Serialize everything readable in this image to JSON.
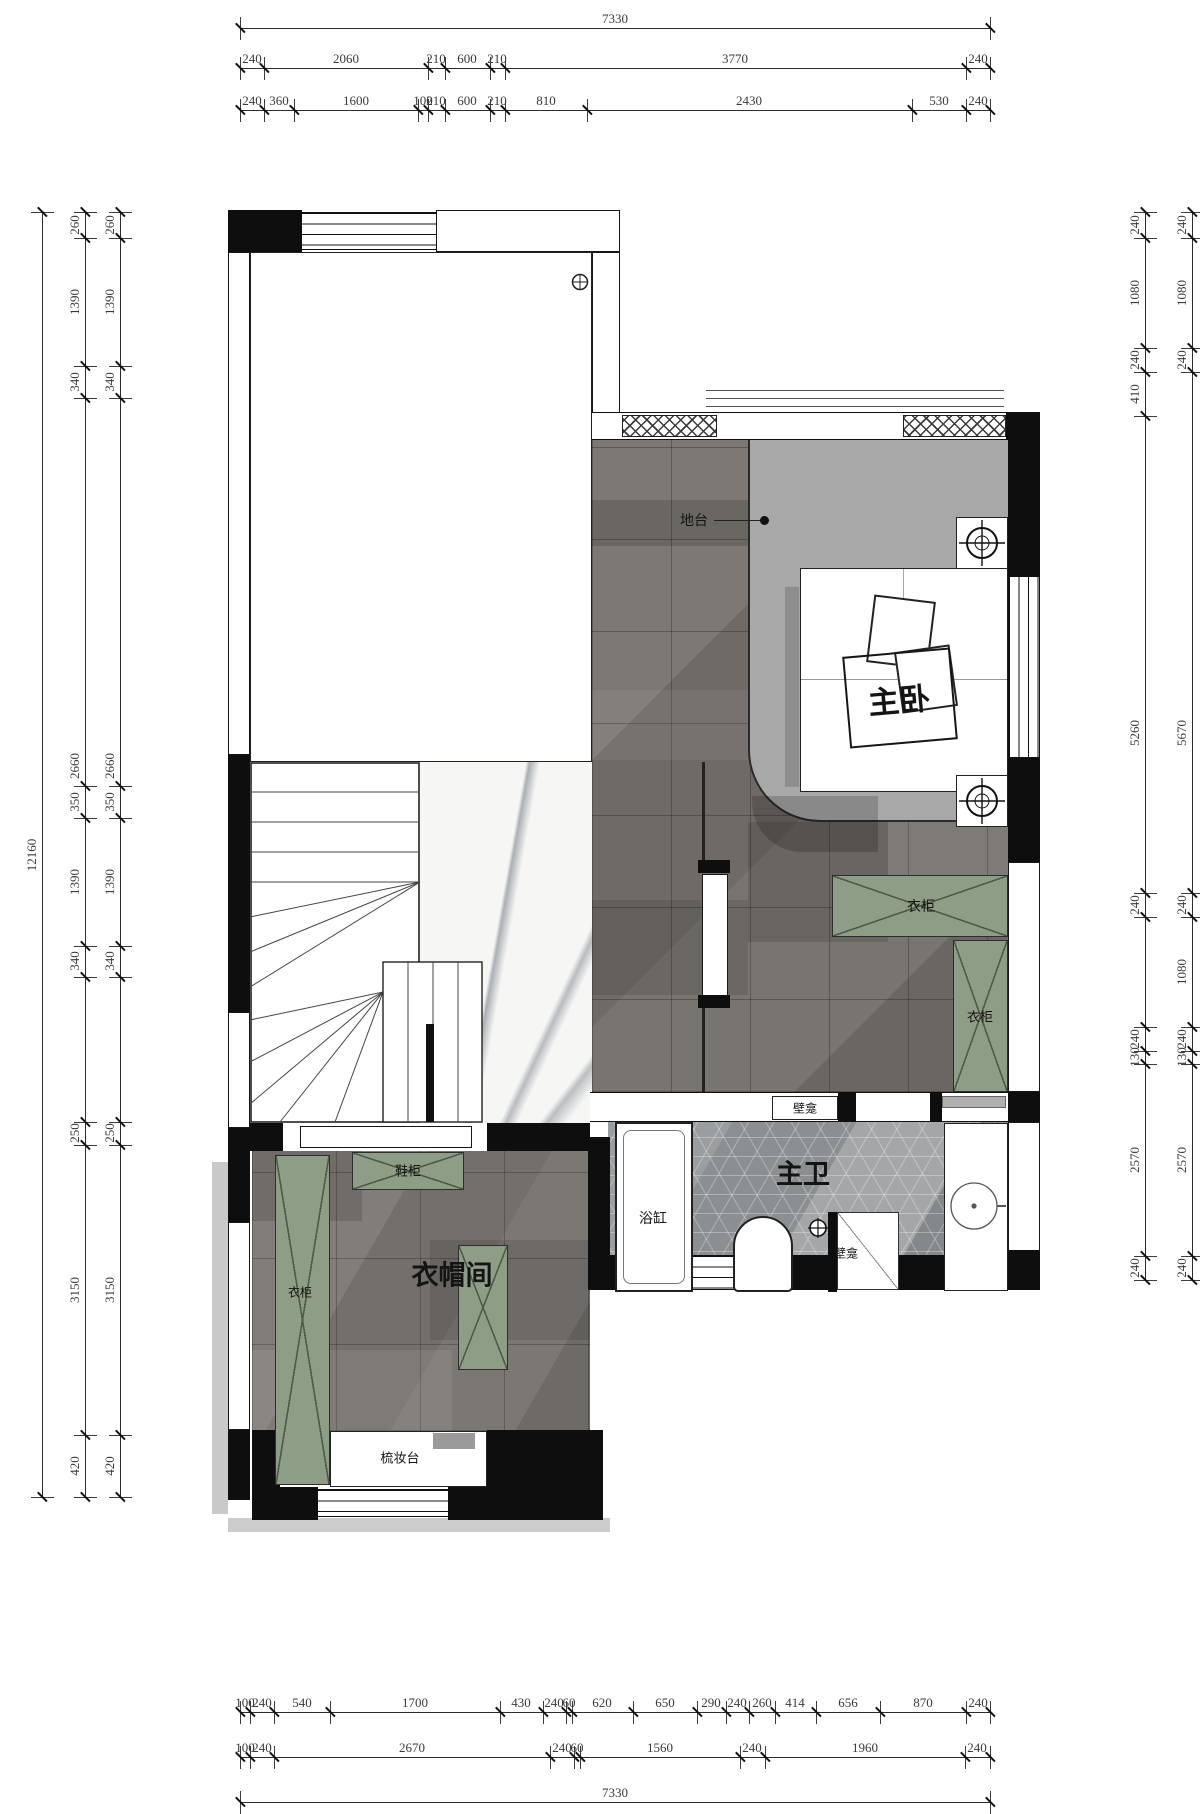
{
  "drawing": {
    "overall_width_label": "7330",
    "overall_height_label": "12160"
  },
  "plan_labels": [
    {
      "name": "label-platform",
      "text": "地台",
      "x": 694,
      "y": 520,
      "size": 14,
      "bold": false,
      "rot": 0
    },
    {
      "name": "label-master-bedroom",
      "text": "主卧",
      "x": 899,
      "y": 698,
      "size": 31,
      "bold": true,
      "rot": -5
    },
    {
      "name": "label-wardrobe-1",
      "text": "衣柜",
      "x": 921,
      "y": 906,
      "size": 14,
      "bold": false,
      "rot": 0
    },
    {
      "name": "label-wardrobe-2",
      "text": "衣柜",
      "x": 980,
      "y": 1016,
      "size": 13,
      "bold": false,
      "rot": 0
    },
    {
      "name": "label-wardrobe-3",
      "text": "衣柜",
      "x": 300,
      "y": 1292,
      "size": 12,
      "bold": false,
      "rot": 0
    },
    {
      "name": "label-shoe-cabinet",
      "text": "鞋柜",
      "x": 408,
      "y": 1170,
      "size": 13,
      "bold": false,
      "rot": 0
    },
    {
      "name": "label-walkin-closet",
      "text": "衣帽间",
      "x": 452,
      "y": 1273,
      "size": 27,
      "bold": true,
      "rot": 0
    },
    {
      "name": "label-dressing-table",
      "text": "梳妆台",
      "x": 400,
      "y": 1457,
      "size": 13,
      "bold": false,
      "rot": 0
    },
    {
      "name": "label-master-bath",
      "text": "主卫",
      "x": 803,
      "y": 1172,
      "size": 27,
      "bold": true,
      "rot": 0
    },
    {
      "name": "label-bathtub",
      "text": "浴缸",
      "x": 653,
      "y": 1218,
      "size": 14,
      "bold": false,
      "rot": 0
    },
    {
      "name": "label-niche-1",
      "text": "壁龛",
      "x": 805,
      "y": 1108,
      "size": 12,
      "bold": false,
      "rot": 0
    },
    {
      "name": "label-niche-2",
      "text": "壁龛",
      "x": 846,
      "y": 1253,
      "size": 12,
      "bold": false,
      "rot": 0
    }
  ],
  "dimensions": {
    "chains": [
      {
        "name": "dim-top-overall",
        "axis": "h",
        "line": 28,
        "from": 240,
        "to": 990,
        "ticks": [
          240,
          990
        ],
        "labels": [
          {
            "t": "7330",
            "at": 615
          }
        ]
      },
      {
        "name": "dim-top-mid",
        "axis": "h",
        "line": 68,
        "from": 240,
        "to": 990,
        "ticks": [
          240,
          264,
          428,
          445,
          490,
          505,
          966,
          990
        ],
        "labels": [
          {
            "t": "240",
            "at": 252
          },
          {
            "t": "2060",
            "at": 346
          },
          {
            "t": "210",
            "at": 436
          },
          {
            "t": "600",
            "at": 467
          },
          {
            "t": "210",
            "at": 497
          },
          {
            "t": "3770",
            "at": 735
          },
          {
            "t": "240",
            "at": 978
          }
        ]
      },
      {
        "name": "dim-top-fine",
        "axis": "h",
        "line": 110,
        "from": 240,
        "to": 990,
        "ticks": [
          240,
          264,
          294,
          418,
          428,
          445,
          490,
          505,
          587,
          912,
          966,
          990
        ],
        "labels": [
          {
            "t": "240",
            "at": 252
          },
          {
            "t": "360",
            "at": 279
          },
          {
            "t": "1600",
            "at": 356
          },
          {
            "t": "100",
            "at": 423
          },
          {
            "t": "210",
            "at": 436
          },
          {
            "t": "600",
            "at": 467
          },
          {
            "t": "210",
            "at": 497
          },
          {
            "t": "810",
            "at": 546
          },
          {
            "t": "2430",
            "at": 749
          },
          {
            "t": "530",
            "at": 939
          },
          {
            "t": "240",
            "at": 978
          }
        ]
      },
      {
        "name": "dim-bottom-fine",
        "axis": "h",
        "line": 1712,
        "from": 240,
        "to": 990,
        "text_dy": -17,
        "ticks": [
          240,
          250,
          274,
          330,
          500,
          543,
          566,
          572,
          633,
          697,
          726,
          749,
          775,
          816,
          880,
          966,
          990
        ],
        "labels": [
          {
            "t": "100",
            "at": 245
          },
          {
            "t": "240",
            "at": 262
          },
          {
            "t": "540",
            "at": 302
          },
          {
            "t": "1700",
            "at": 415
          },
          {
            "t": "430",
            "at": 521
          },
          {
            "t": "240",
            "at": 554
          },
          {
            "t": "60",
            "at": 569
          },
          {
            "t": "620",
            "at": 602
          },
          {
            "t": "650",
            "at": 665
          },
          {
            "t": "290",
            "at": 711
          },
          {
            "t": "240",
            "at": 737
          },
          {
            "t": "260",
            "at": 762
          },
          {
            "t": "414",
            "at": 795
          },
          {
            "t": "656",
            "at": 848
          },
          {
            "t": "870",
            "at": 923
          },
          {
            "t": "240",
            "at": 978
          }
        ]
      },
      {
        "name": "dim-bottom-mid",
        "axis": "h",
        "line": 1757,
        "from": 240,
        "to": 990,
        "ticks": [
          240,
          250,
          274,
          550,
          574,
          580,
          740,
          765,
          965,
          990
        ],
        "labels": [
          {
            "t": "100",
            "at": 245
          },
          {
            "t": "240",
            "at": 262
          },
          {
            "t": "2670",
            "at": 412
          },
          {
            "t": "240",
            "at": 562
          },
          {
            "t": "60",
            "at": 577
          },
          {
            "t": "1560",
            "at": 660
          },
          {
            "t": "240",
            "at": 752
          },
          {
            "t": "1960",
            "at": 865
          },
          {
            "t": "240",
            "at": 977
          }
        ]
      },
      {
        "name": "dim-bottom-overall",
        "axis": "h",
        "line": 1802,
        "from": 240,
        "to": 990,
        "ticks": [
          240,
          990
        ],
        "labels": [
          {
            "t": "7330",
            "at": 615
          }
        ]
      },
      {
        "name": "dim-left-overall",
        "axis": "v",
        "line": 42,
        "from": 212,
        "to": 1497,
        "ticks": [
          212,
          1497
        ],
        "labels": [
          {
            "t": "12160",
            "at": 855
          }
        ]
      },
      {
        "name": "dim-left-mid",
        "axis": "v",
        "line": 85,
        "from": 212,
        "to": 1497,
        "ticks": [
          212,
          238,
          366,
          398,
          786,
          818,
          946,
          977,
          1122,
          1145,
          1435,
          1497
        ],
        "labels": [
          {
            "t": "260",
            "at": 225
          },
          {
            "t": "1390",
            "at": 302
          },
          {
            "t": "340",
            "at": 382
          },
          {
            "t": "2660",
            "at": 766
          },
          {
            "t": "350",
            "at": 802
          },
          {
            "t": "1390",
            "at": 882
          },
          {
            "t": "340",
            "at": 961
          },
          {
            "t": "250",
            "at": 1133
          },
          {
            "t": "3150",
            "at": 1290
          },
          {
            "t": "420",
            "at": 1466
          }
        ]
      },
      {
        "name": "dim-left-fine",
        "axis": "v",
        "line": 120,
        "from": 212,
        "to": 1497,
        "ticks": [
          212,
          238,
          366,
          398,
          786,
          818,
          946,
          977,
          1122,
          1145,
          1435,
          1497
        ],
        "labels": [
          {
            "t": "260",
            "at": 225
          },
          {
            "t": "1390",
            "at": 302
          },
          {
            "t": "340",
            "at": 382
          },
          {
            "t": "2660",
            "at": 766
          },
          {
            "t": "350",
            "at": 802
          },
          {
            "t": "1390",
            "at": 882
          },
          {
            "t": "340",
            "at": 961
          },
          {
            "t": "250",
            "at": 1133
          },
          {
            "t": "3150",
            "at": 1290
          },
          {
            "t": "420",
            "at": 1466
          }
        ]
      },
      {
        "name": "dim-right-inner",
        "axis": "v",
        "line": 1145,
        "from": 212,
        "to": 1280,
        "ticks": [
          212,
          238,
          348,
          372,
          416,
          893,
          917,
          1027,
          1051,
          1064,
          1256,
          1280
        ],
        "labels": [
          {
            "t": "240",
            "at": 225
          },
          {
            "t": "1080",
            "at": 293
          },
          {
            "t": "240",
            "at": 360
          },
          {
            "t": "410",
            "at": 394
          },
          {
            "t": "5260",
            "at": 733
          },
          {
            "t": "240",
            "at": 905
          },
          {
            "t": "240",
            "at": 1039
          },
          {
            "t": "130",
            "at": 1057
          },
          {
            "t": "2570",
            "at": 1160
          },
          {
            "t": "240",
            "at": 1268
          }
        ]
      },
      {
        "name": "dim-right-outer",
        "axis": "v",
        "line": 1192,
        "from": 212,
        "to": 1280,
        "ticks": [
          212,
          238,
          348,
          372,
          893,
          917,
          1027,
          1051,
          1064,
          1256,
          1280
        ],
        "labels": [
          {
            "t": "240",
            "at": 225
          },
          {
            "t": "1080",
            "at": 293
          },
          {
            "t": "240",
            "at": 360
          },
          {
            "t": "5670",
            "at": 733
          },
          {
            "t": "240",
            "at": 905
          },
          {
            "t": "1080",
            "at": 972
          },
          {
            "t": "240",
            "at": 1039
          },
          {
            "t": "130",
            "at": 1057
          },
          {
            "t": "2570",
            "at": 1160
          },
          {
            "t": "240",
            "at": 1268
          }
        ]
      }
    ]
  }
}
